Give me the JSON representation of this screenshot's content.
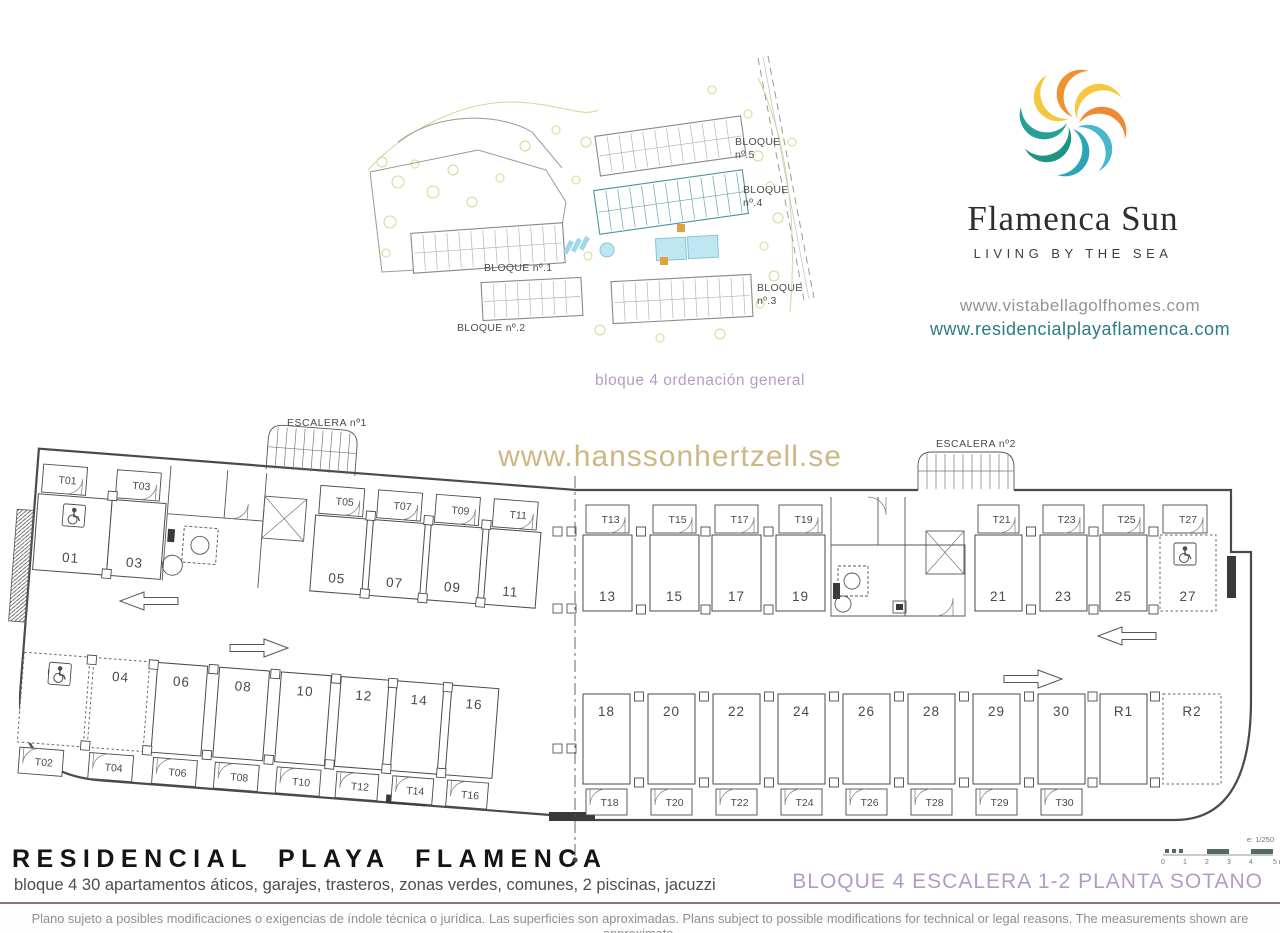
{
  "brand": {
    "name": "Flamenca Sun",
    "tagline": "LIVING BY THE SEA",
    "url_primary": "www.vistabellagolfhomes.com",
    "url_secondary": "www.residencialplayaflamenca.com",
    "petal_colors": [
      "#ee8a33",
      "#49b6ce",
      "#2ba6b8",
      "#1f9386",
      "#25a097",
      "#f5c73e",
      "#ef9330",
      "#f6c73f"
    ]
  },
  "site_plan": {
    "caption": "bloque 4 ordenación general",
    "highlight_color": "#a9d9e6",
    "block_labels": {
      "b5": [
        "BLOQUE",
        "nº.5"
      ],
      "b4": [
        "BLOQUE",
        "nº.4"
      ],
      "b3": [
        "BLOQUE",
        "nº.3"
      ],
      "b1": "BLOQUE nº.1",
      "b2": "BLOQUE nº.2"
    }
  },
  "watermark": "www.hanssonhertzell.se",
  "plan": {
    "escalera1": "ESCALERA nº1",
    "escalera2": "ESCALERA nº2",
    "rows": {
      "top_left": [
        {
          "n": "01",
          "t": "T01",
          "handicap": true
        },
        {
          "n": "03",
          "t": "T03"
        },
        {
          "n": "05",
          "t": "T05"
        },
        {
          "n": "07",
          "t": "T07"
        },
        {
          "n": "09",
          "t": "T09"
        },
        {
          "n": "11",
          "t": "T11"
        }
      ],
      "top_right": [
        {
          "n": "13",
          "t": "T13"
        },
        {
          "n": "15",
          "t": "T15"
        },
        {
          "n": "17",
          "t": "T17"
        },
        {
          "n": "19",
          "t": "T19"
        },
        {
          "n": "21",
          "t": "T21"
        },
        {
          "n": "23",
          "t": "T23"
        },
        {
          "n": "25",
          "t": "T25"
        },
        {
          "n": "27",
          "t": "T27",
          "handicap": true,
          "dashed": true
        }
      ],
      "bottom_left": [
        {
          "n": "02",
          "t": "T02",
          "handicap": true,
          "dashed": true
        },
        {
          "n": "04",
          "t": "T04",
          "dashed": true
        },
        {
          "n": "06",
          "t": "T06"
        },
        {
          "n": "08",
          "t": "T08"
        },
        {
          "n": "10",
          "t": "T10"
        },
        {
          "n": "12",
          "t": "T12"
        },
        {
          "n": "14",
          "t": "T14"
        },
        {
          "n": "16",
          "t": "T16"
        }
      ],
      "bottom_right": [
        {
          "n": "18",
          "t": "T18"
        },
        {
          "n": "20",
          "t": "T20"
        },
        {
          "n": "22",
          "t": "T22"
        },
        {
          "n": "24",
          "t": "T24"
        },
        {
          "n": "26",
          "t": "T26"
        },
        {
          "n": "28",
          "t": "T28"
        },
        {
          "n": "29",
          "t": "T29"
        },
        {
          "n": "30",
          "t": "T30"
        },
        {
          "n": "R1"
        },
        {
          "n": "R2",
          "dashed": true
        }
      ]
    }
  },
  "scale_bar": {
    "label": "e: 1/250",
    "ticks": [
      "0",
      "1",
      "2",
      "3",
      "4",
      "5 m"
    ]
  },
  "footer": {
    "title": "RESIDENCIAL PLAYA FLAMENCA",
    "subtitle": "bloque 4 30 apartamentos áticos, garajes, trasteros, zonas verdes, comunes, 2 piscinas, jacuzzi",
    "sheet_label": "BLOQUE 4 ESCALERA 1-2 PLANTA SOTANO",
    "disclaimer": "Plano sujeto a posibles modificaciones o exigencias de índole técnica o jurídica. Las superficies son aproximadas. Plans subject to possible modifications for technical or legal reasons. The measurements shown are approximate."
  },
  "colors": {
    "accent_purple": "#b49bc7",
    "watermark_gold": "#c8b177",
    "plan_line": "#4a4a4a",
    "url_teal": "#2c7b80"
  }
}
